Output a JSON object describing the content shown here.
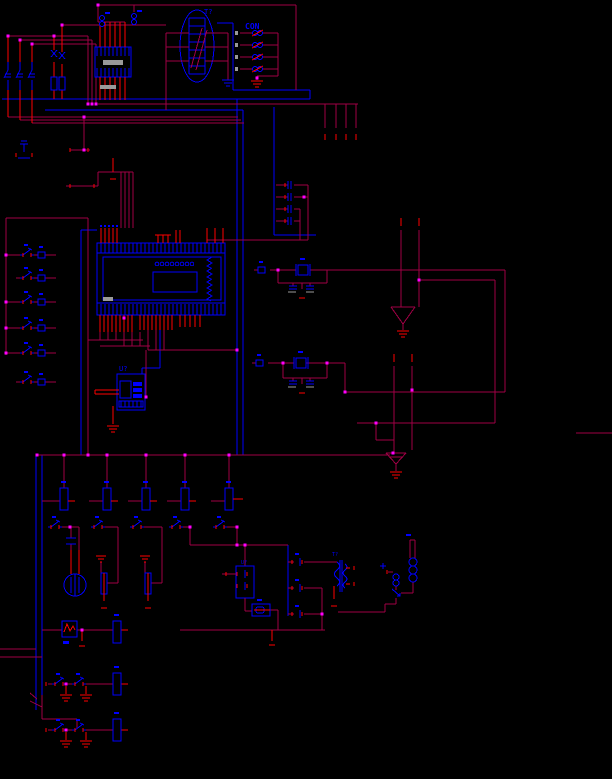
{
  "canvas": {
    "width": 612,
    "height": 779,
    "background": "#000000"
  },
  "palette": {
    "wire": "#A00045",
    "component": "#0000FE",
    "pin": "#FF0000",
    "junction": "#FF00FF",
    "pin_end_gray": "#9A9A9A",
    "canvas_bg": "#000000"
  },
  "labels": {
    "transformer_top": "T?",
    "connector_top_right": "CON",
    "ic_bottom_left": "U?",
    "optocoupler": "U?",
    "transformer_bottom": "T?"
  },
  "structure": {
    "input_switch_rows": 6,
    "relay_driver_columns": 5,
    "con_coil_count": 4,
    "output_rows": 3,
    "diode_column_count": 3,
    "breaker_poles": 3
  }
}
